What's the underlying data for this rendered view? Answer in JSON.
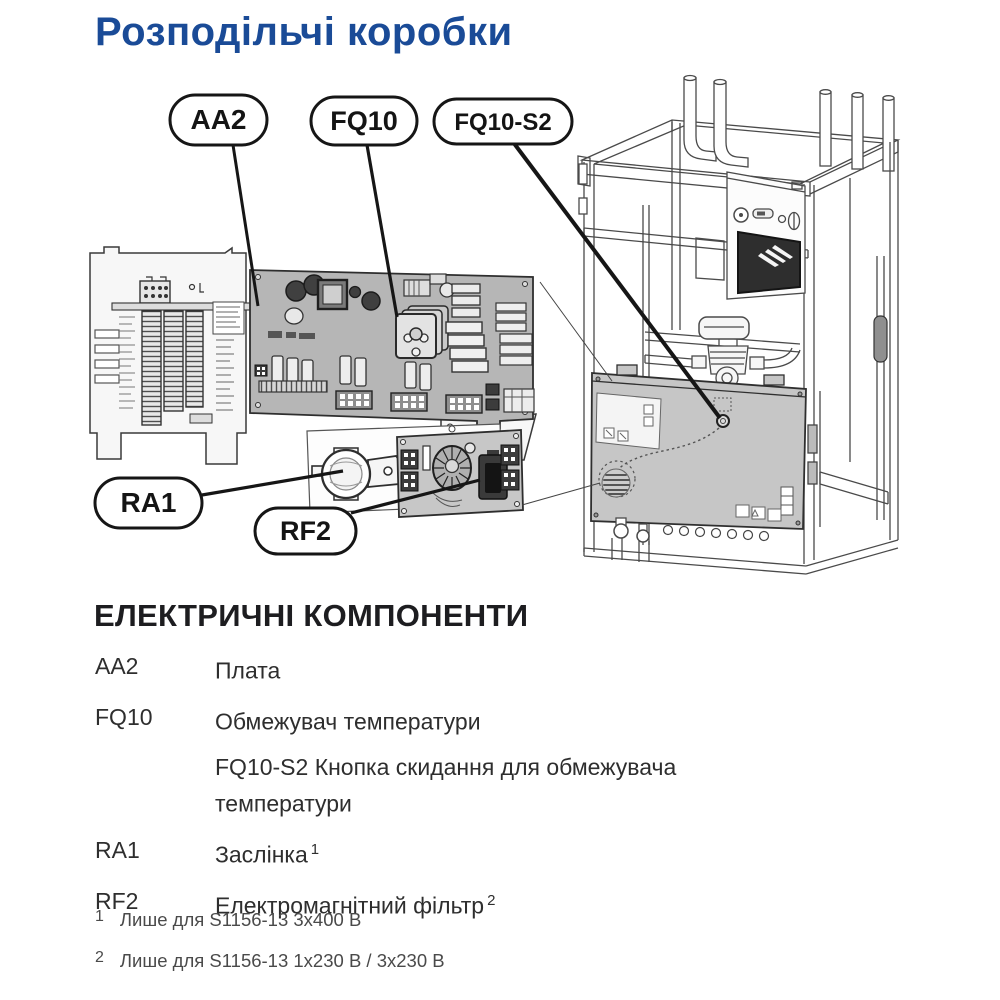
{
  "page": {
    "title": "Розподільчі коробки"
  },
  "diagram": {
    "description": "Exploded view of distribution boxes: wiring terminal panel, AA2 base board, RA1 damper with RF2 EMC filter board, and heat pump cabinet showing electrical box with FQ10-S2 reset button",
    "callouts": [
      {
        "id": "aa2",
        "label": "AA2"
      },
      {
        "id": "fq10",
        "label": "FQ10"
      },
      {
        "id": "fq10-s2",
        "label": "FQ10-S2"
      },
      {
        "id": "ra1",
        "label": "RA1"
      },
      {
        "id": "rf2",
        "label": "RF2"
      }
    ]
  },
  "components": {
    "heading": "ЕЛЕКТРИЧНІ КОМПОНЕНТИ",
    "items": [
      {
        "term": "AA2",
        "desc": "Плата",
        "sup": ""
      },
      {
        "term": "FQ10",
        "desc": "Обмежувач температури",
        "sup": ""
      },
      {
        "term": "",
        "desc": "FQ10-S2 Кнопка скидання для обмежувача температури",
        "sup": ""
      },
      {
        "term": "RA1",
        "desc": "Заслінка",
        "sup": "1"
      },
      {
        "term": "RF2",
        "desc": "Електромагнітний фільтр",
        "sup": "2"
      }
    ]
  },
  "footnotes": [
    {
      "sup": "1",
      "text": "Лише для S1156-13 3x400 В"
    },
    {
      "sup": "2",
      "text": "Лише для S1156-13 1x230 В / 3x230 В"
    }
  ],
  "colors": {
    "title_blue": "#1a4b97",
    "heading_black": "#1d1d20",
    "body_text": "#2e2e2e",
    "footnote_gray": "#4a4a4a",
    "pcb_gray": "#b6b6b6",
    "box_cover_gray": "#c6c6c6",
    "line_art": "#4a4a4a"
  }
}
